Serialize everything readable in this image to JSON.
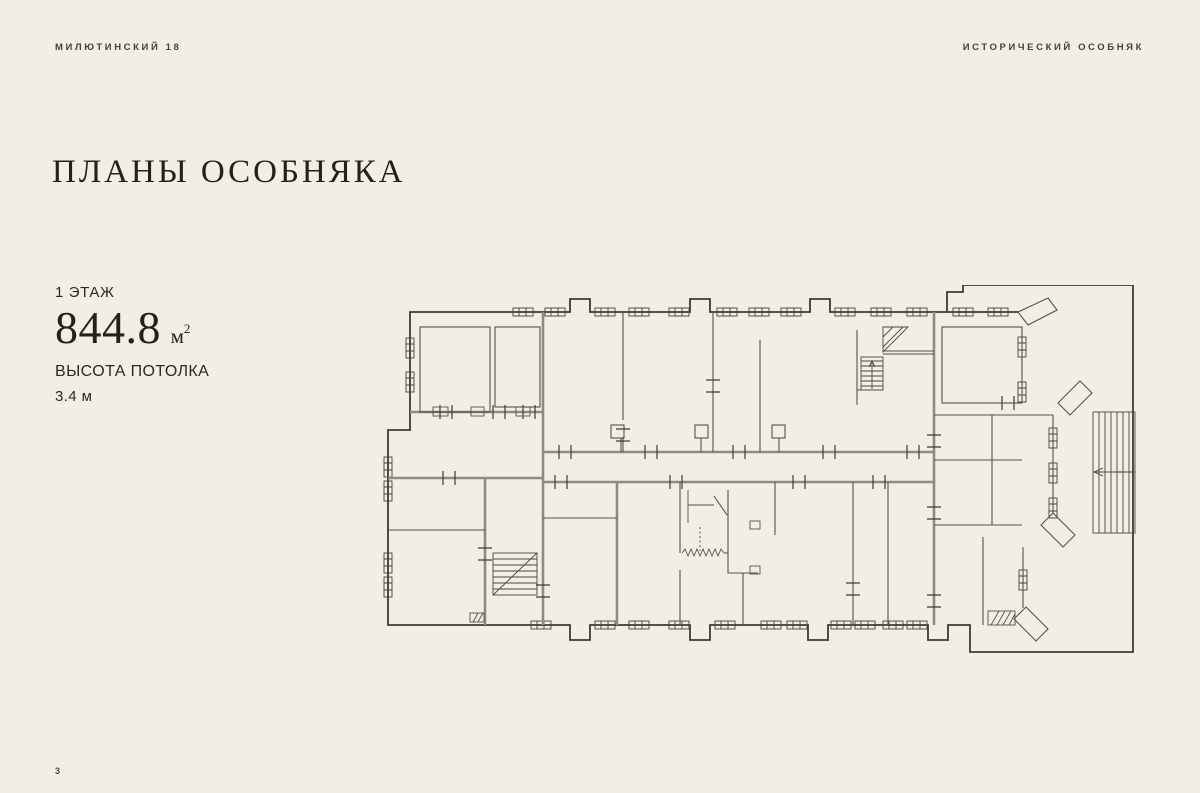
{
  "page": {
    "background": "#f2eee5",
    "text_color": "#2b2922",
    "plan_line_color": "#3e3b34",
    "plan_wall_gray": "#8f8b81",
    "page_number": "3"
  },
  "header": {
    "left": "МИЛЮТИНСКИЙ 18",
    "right": "ИСТОРИЧЕСКИЙ ОСОБНЯК"
  },
  "title": "ПЛАНЫ ОСОБНЯКА",
  "floor_info": {
    "floor_label": "1 ЭТАЖ",
    "area_value": "844.8",
    "area_unit": "м",
    "area_exponent": "2",
    "ceiling_label": "ВЫСОТА ПОТОЛКА",
    "ceiling_value": "3.4 м"
  }
}
